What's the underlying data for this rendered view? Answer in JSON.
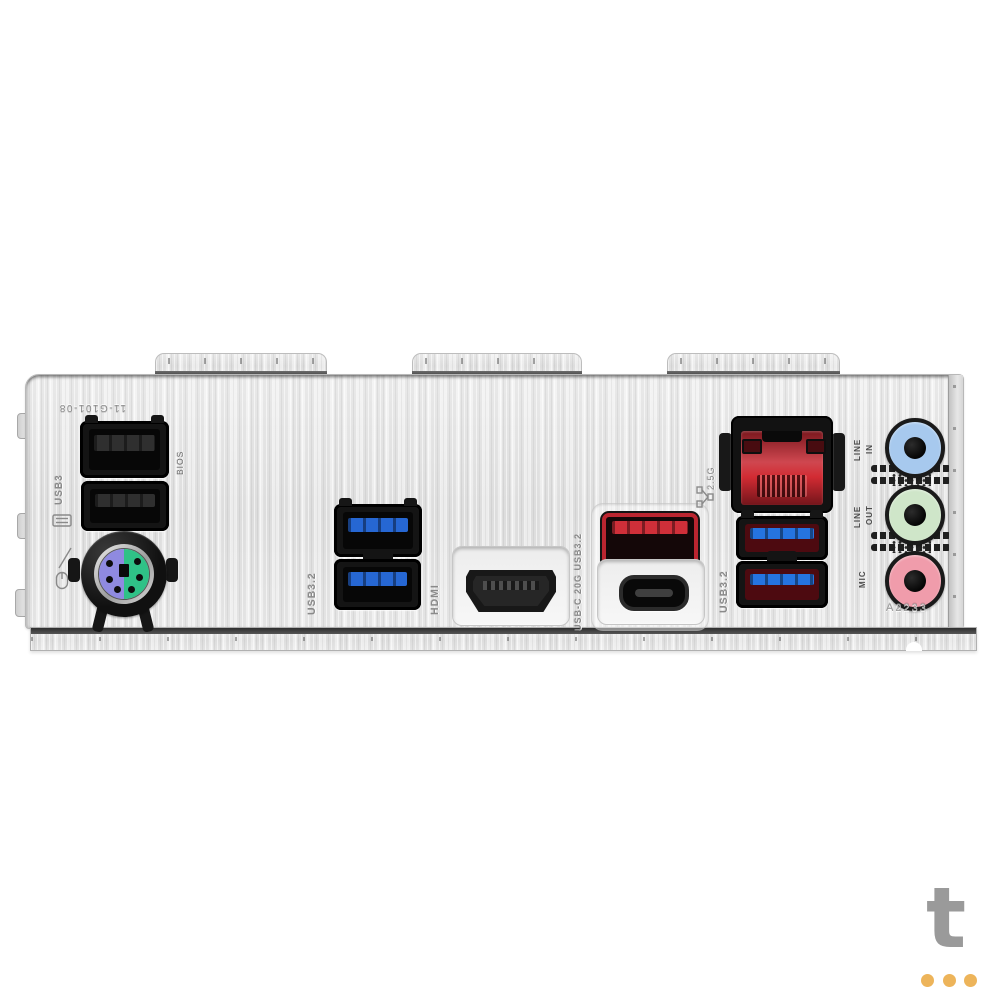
{
  "stamps": {
    "part_number": "11-G101-08",
    "usb2_group_label": "USB3",
    "bios_label": "BIOS",
    "usb32_mid_label": "USB3.2",
    "hdmi_label": "HDMI",
    "usbc_label": "USB-C 20G USB3.2",
    "lan_speed_label": "2.5G",
    "usb32_right_label": "USB3.2",
    "date_code": "A2233",
    "audio_in": [
      "LINE",
      "IN"
    ],
    "audio_out": [
      "LINE",
      "OUT"
    ],
    "audio_mic": "MIC"
  },
  "colors": {
    "usb2_tongue": "#2f2f2f",
    "usb3_tongue": "#2667d3",
    "usb3_right_tongue": "#2574e0",
    "red_port_frame": "#bb2530",
    "red_port_tongue": "#cf2f39",
    "lan_red": "#c6242e",
    "jack_line_in": "#a7c9ee",
    "jack_line_out": "#cfe6c9",
    "jack_mic": "#f09cab",
    "ps2_purple": "#8f8ae0",
    "ps2_green": "#2fc287",
    "watermark_letter": "#9a9a9a",
    "watermark_dot": "#edb45a"
  },
  "watermark": {
    "letter": "t"
  }
}
